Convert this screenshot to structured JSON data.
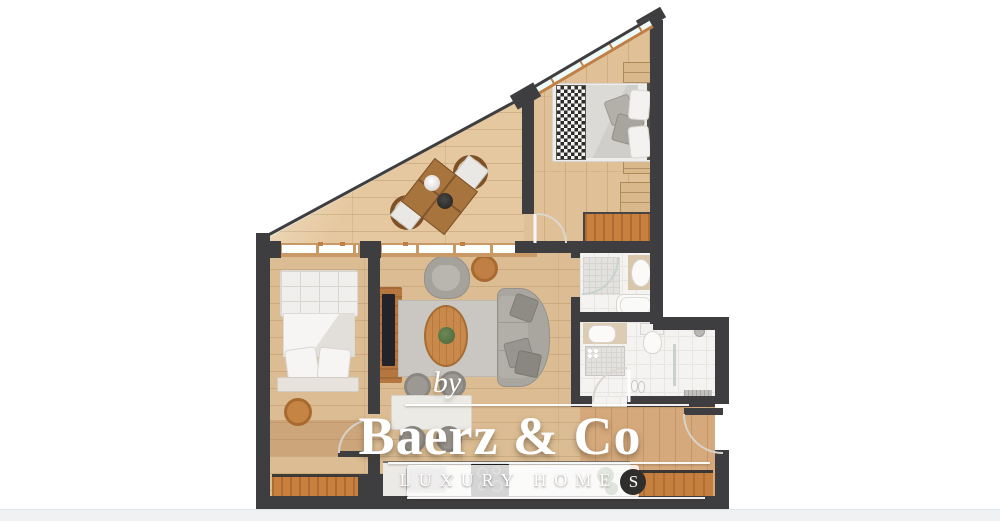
{
  "watermark": {
    "by_label": "by",
    "brand": "Baerz & Co",
    "tagline_main": "LUXURY HOME",
    "tagline_s": "S"
  },
  "palette": {
    "wall": "#3e3d3f",
    "floor_light": "#e5c89f",
    "floor_mid": "#dcbd93",
    "floor_hall": "#d5a97b",
    "accent_wood": "#c9803f",
    "window_frame": "#c08045",
    "glass": "#eefaf8",
    "bath_tile": "#f4f3f1",
    "furniture_gray": "#a9a6a0",
    "watermark_text": "#ffffff",
    "banner_circle": "#2f2e2c"
  }
}
